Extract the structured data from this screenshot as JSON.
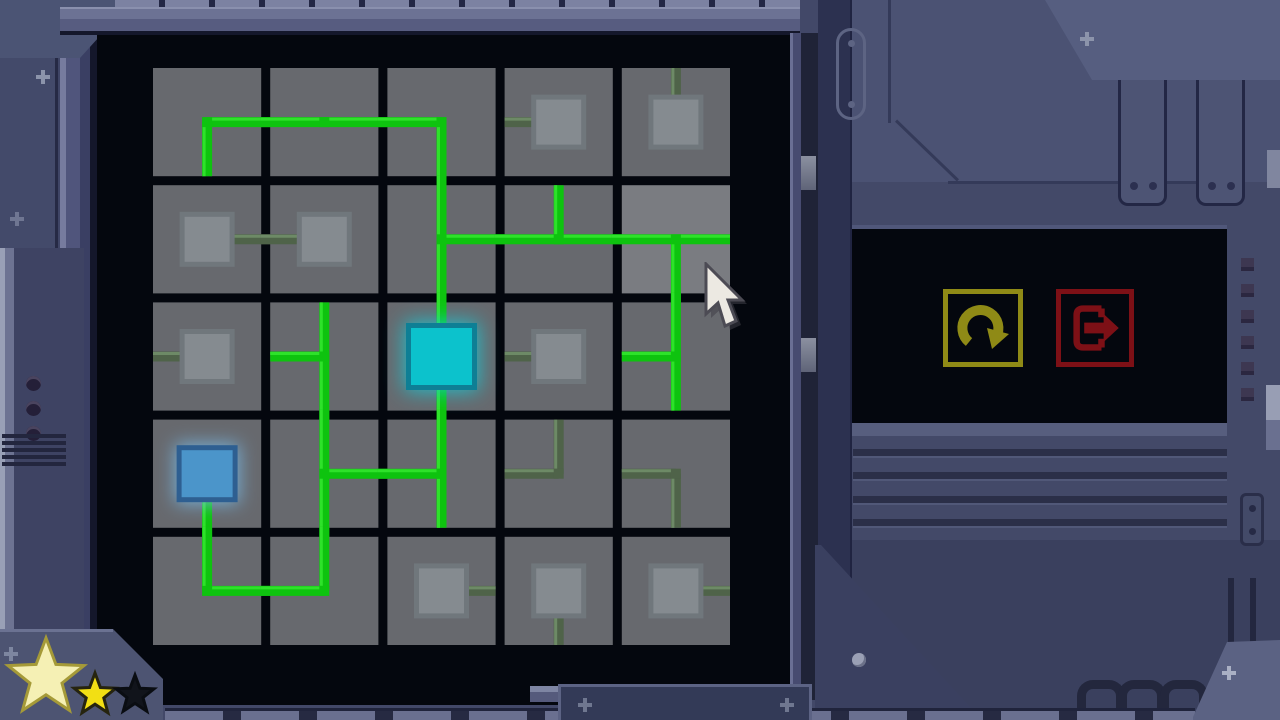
{
  "game": {
    "name": "circuit-connection-puzzle",
    "status": "in-progress"
  },
  "board": {
    "rows": 5,
    "cols": 5,
    "origin": {
      "x": 153,
      "y": 68
    },
    "pitch": 117.2,
    "cell": 108.2,
    "gap": 9,
    "colors": {
      "tile": "#67696e",
      "tile_hover": "#7a7c81",
      "screen_bg": "#04070e",
      "wire_bright": "#0ec30f",
      "wire_bright_hi": "#2ee22a",
      "wire_faint": "#4f6349",
      "wire_faint_hi": "#6d8a66",
      "node_fill": "#858b90",
      "node_ring": "#70777c",
      "source_fill": "#0cc2cc",
      "source_ring": "#0e7f95",
      "source_glow": "#17ccd8",
      "goal_fill": "#4b95ca",
      "goal_ring": "#2e5f91",
      "goal_glow": "#79bbe8"
    },
    "cells": [
      {
        "r": 0,
        "c": 0,
        "kind": "wire",
        "arms": "RD",
        "power": "bright",
        "hover": false
      },
      {
        "r": 0,
        "c": 1,
        "kind": "wire",
        "arms": "LR",
        "power": "bright",
        "hover": false
      },
      {
        "r": 0,
        "c": 2,
        "kind": "wire",
        "arms": "LD",
        "power": "bright",
        "hover": false
      },
      {
        "r": 0,
        "c": 3,
        "kind": "node",
        "arms": "L",
        "power": "faint",
        "hover": false
      },
      {
        "r": 0,
        "c": 4,
        "kind": "node",
        "arms": "U",
        "power": "faint",
        "hover": false
      },
      {
        "r": 1,
        "c": 0,
        "kind": "node",
        "arms": "R",
        "power": "faint",
        "hover": false
      },
      {
        "r": 1,
        "c": 1,
        "kind": "node",
        "arms": "L",
        "power": "faint",
        "hover": false
      },
      {
        "r": 1,
        "c": 2,
        "kind": "wire",
        "arms": "UDR",
        "power": "bright",
        "hover": false
      },
      {
        "r": 1,
        "c": 3,
        "kind": "wire",
        "arms": "ULR",
        "power": "bright",
        "hover": false
      },
      {
        "r": 1,
        "c": 4,
        "kind": "wire",
        "arms": "LRD",
        "power": "bright",
        "hover": true
      },
      {
        "r": 2,
        "c": 0,
        "kind": "node",
        "arms": "L",
        "power": "faint",
        "hover": false
      },
      {
        "r": 2,
        "c": 1,
        "kind": "wire",
        "arms": "UDL",
        "power": "bright",
        "hover": false
      },
      {
        "r": 2,
        "c": 2,
        "kind": "source",
        "arms": "UD",
        "power": "bright",
        "hover": false
      },
      {
        "r": 2,
        "c": 3,
        "kind": "node",
        "arms": "L",
        "power": "faint",
        "hover": false
      },
      {
        "r": 2,
        "c": 4,
        "kind": "wire",
        "arms": "UDL",
        "power": "bright",
        "hover": false
      },
      {
        "r": 3,
        "c": 0,
        "kind": "goal",
        "arms": "D",
        "power": "bright",
        "hover": false
      },
      {
        "r": 3,
        "c": 1,
        "kind": "wire",
        "arms": "UDR",
        "power": "bright",
        "hover": false
      },
      {
        "r": 3,
        "c": 2,
        "kind": "wire",
        "arms": "UDL",
        "power": "bright",
        "hover": false
      },
      {
        "r": 3,
        "c": 3,
        "kind": "wire",
        "arms": "UL",
        "power": "faint",
        "hover": false
      },
      {
        "r": 3,
        "c": 4,
        "kind": "wire",
        "arms": "LD",
        "power": "faint",
        "hover": false
      },
      {
        "r": 4,
        "c": 0,
        "kind": "wire",
        "arms": "UR",
        "power": "bright",
        "hover": false
      },
      {
        "r": 4,
        "c": 1,
        "kind": "wire",
        "arms": "UL",
        "power": "bright",
        "hover": false
      },
      {
        "r": 4,
        "c": 2,
        "kind": "node",
        "arms": "R",
        "power": "faint",
        "hover": false
      },
      {
        "r": 4,
        "c": 3,
        "kind": "node",
        "arms": "D",
        "power": "faint",
        "hover": false
      },
      {
        "r": 4,
        "c": 4,
        "kind": "node",
        "arms": "R",
        "power": "faint",
        "hover": false
      }
    ]
  },
  "panel": {
    "restart": {
      "name": "restart-level",
      "color": "#8f8a16"
    },
    "exit": {
      "name": "exit-level",
      "color": "#7d1016"
    }
  },
  "stars": {
    "earned": 2,
    "total": 3,
    "items": [
      {
        "size": "large",
        "filled": true,
        "x": 46,
        "y": 58,
        "r": 40,
        "fill": "#f5f0b4",
        "stroke": "#a59a38"
      },
      {
        "size": "medium",
        "filled": true,
        "x": 95,
        "y": 75,
        "r": 22,
        "fill": "#f2df14",
        "stroke": "#26240f"
      },
      {
        "size": "small",
        "filled": false,
        "x": 135,
        "y": 75,
        "r": 20,
        "fill": "#11141b",
        "stroke": "#0a0d12"
      }
    ]
  },
  "cursor": {
    "x": 704,
    "y": 262
  }
}
